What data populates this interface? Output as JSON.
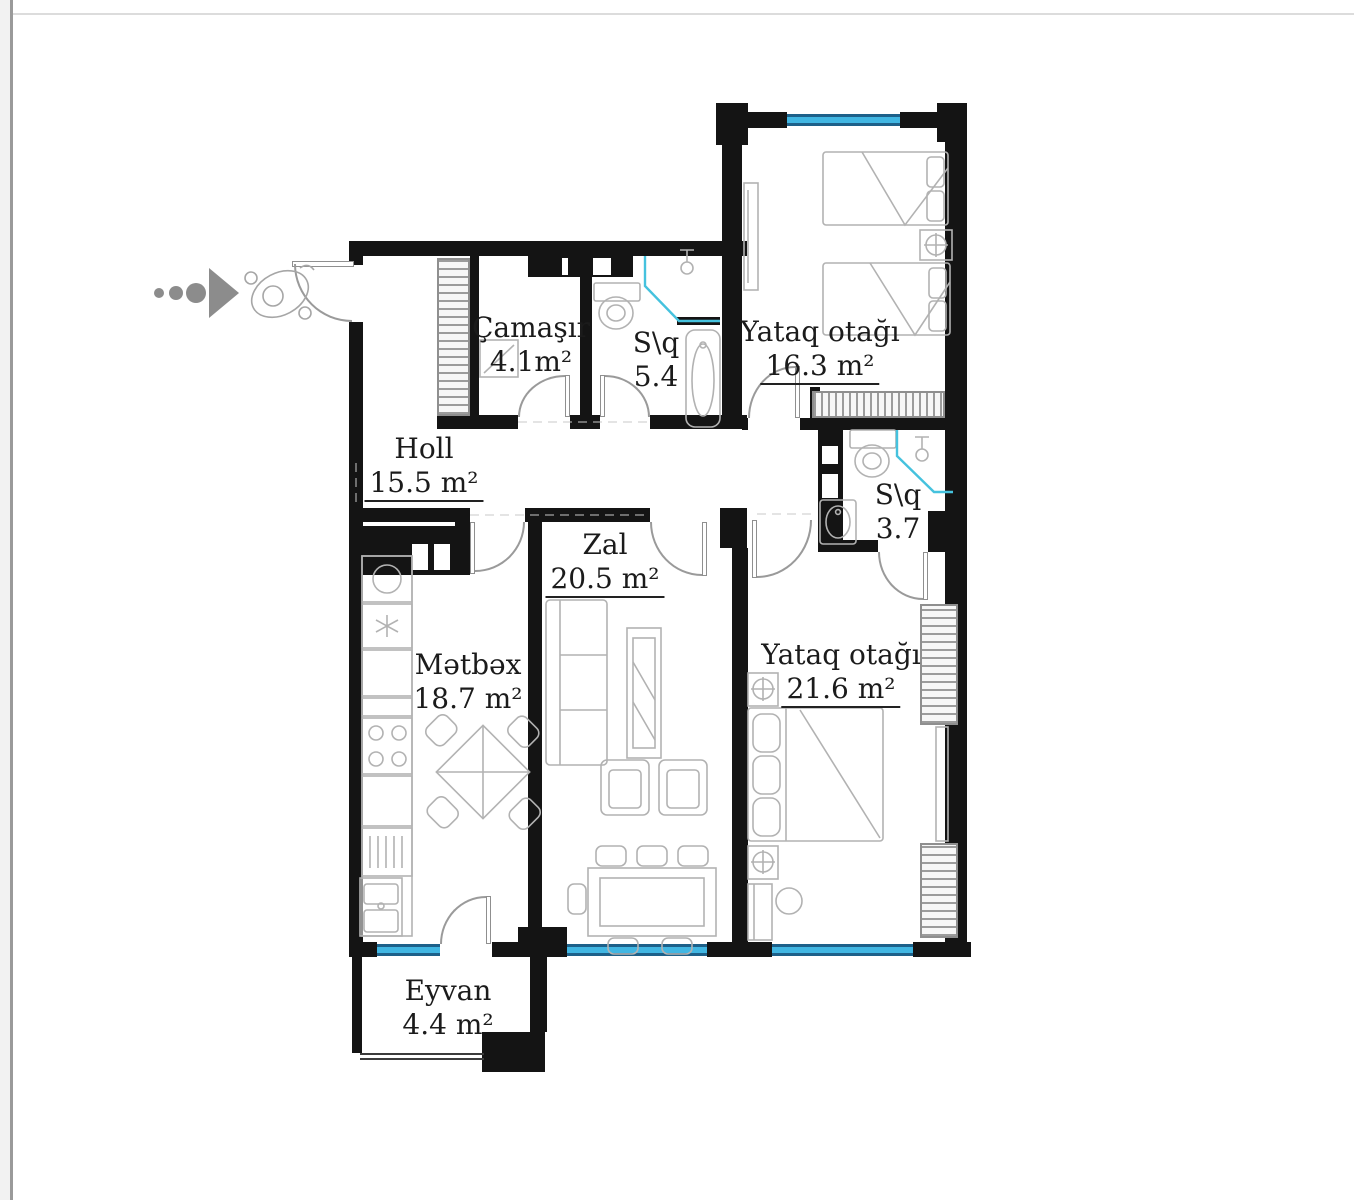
{
  "plan": {
    "title": "apartment-floor-plan",
    "rooms": [
      {
        "id": "camasir",
        "name": "Çamaşır",
        "area": "4.1m²"
      },
      {
        "id": "sq54",
        "name": "S\\q",
        "area": "5.4"
      },
      {
        "id": "bedroom1",
        "name": "Yataq otağı",
        "area": "16.3 m²"
      },
      {
        "id": "holl",
        "name": "Holl",
        "area": "15.5 m²"
      },
      {
        "id": "sq37",
        "name": "S\\q",
        "area": "3.7"
      },
      {
        "id": "zal",
        "name": "Zal",
        "area": "20.5 m²"
      },
      {
        "id": "metbex",
        "name": "Mətbəx",
        "area": "18.7 m²"
      },
      {
        "id": "bedroom2",
        "name": "Yataq otağı",
        "area": "21.6 m²"
      },
      {
        "id": "eyvan",
        "name": "Eyvan",
        "area": "4.4 m²"
      }
    ],
    "indicators": {
      "entry_arrow": "entry-direction-arrow",
      "person_figure": "person-top-view"
    },
    "colors": {
      "wall": "#141414",
      "window_fill": "#41b6e2",
      "window_border": "#1d6089",
      "fixture_line": "#b2b2b2",
      "shower_line": "#45c2de",
      "arrow_gray": "#8c8c8c",
      "text": "#1b1b1b"
    }
  }
}
